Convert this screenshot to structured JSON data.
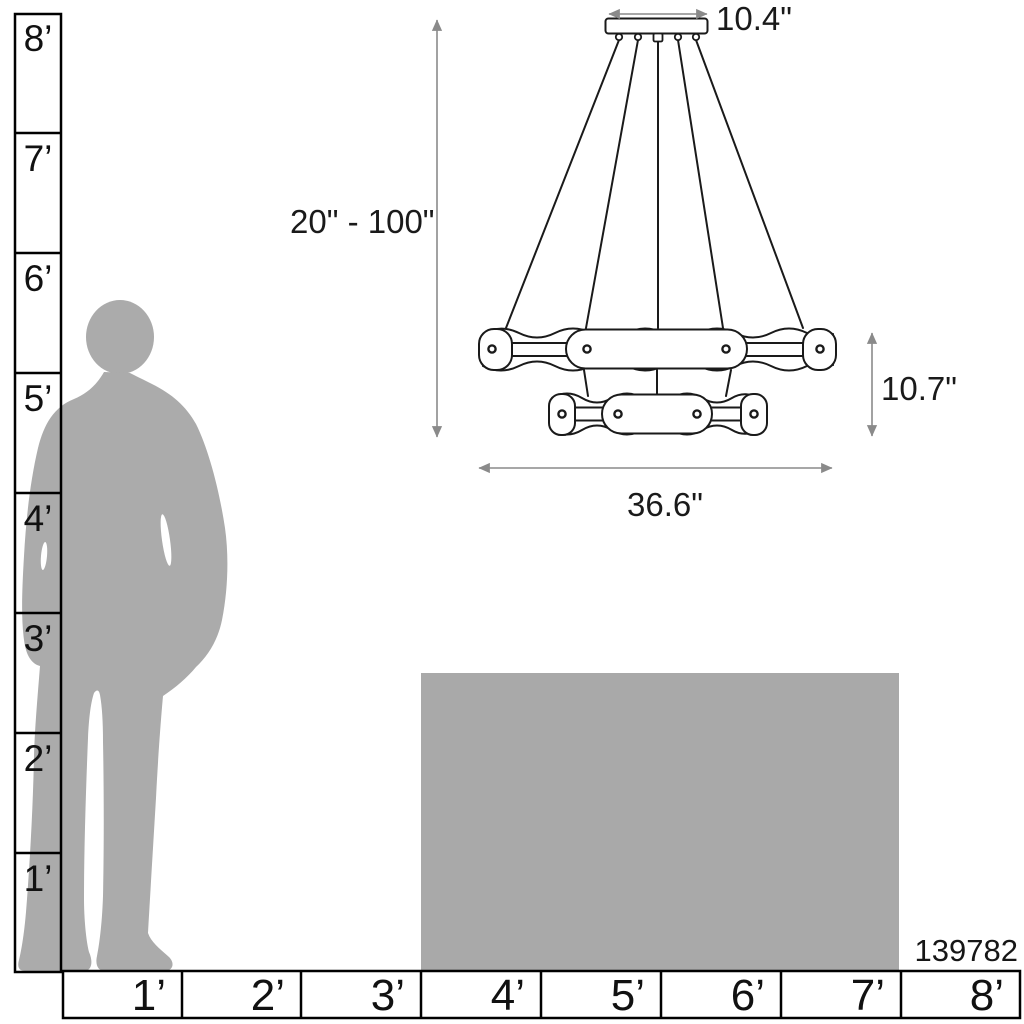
{
  "title": "Chandelier scale and dimensions diagram",
  "product": {
    "number": "139782"
  },
  "dimension_labels": {
    "canopy_width": "10.4\"",
    "suspension_height_range": "20\" - 100\"",
    "fixture_height": "10.7\"",
    "fixture_width": "36.6\""
  },
  "vertical_ruler": {
    "unit": "feet",
    "labels": [
      "8’",
      "7’",
      "6’",
      "5’",
      "4’",
      "3’",
      "2’",
      "1’"
    ]
  },
  "horizontal_ruler": {
    "unit": "feet",
    "labels": [
      "1’",
      "2’",
      "3’",
      "4’",
      "5’",
      "6’",
      "7’",
      "8’"
    ]
  },
  "colors": {
    "background": "#ffffff",
    "line_art": "#1a1a1a",
    "dimension_line": "#8a8a8a",
    "silhouette_gray": "#ababab",
    "reference_box_gray": "#a9a9a9",
    "ruler_border": "#000000"
  }
}
